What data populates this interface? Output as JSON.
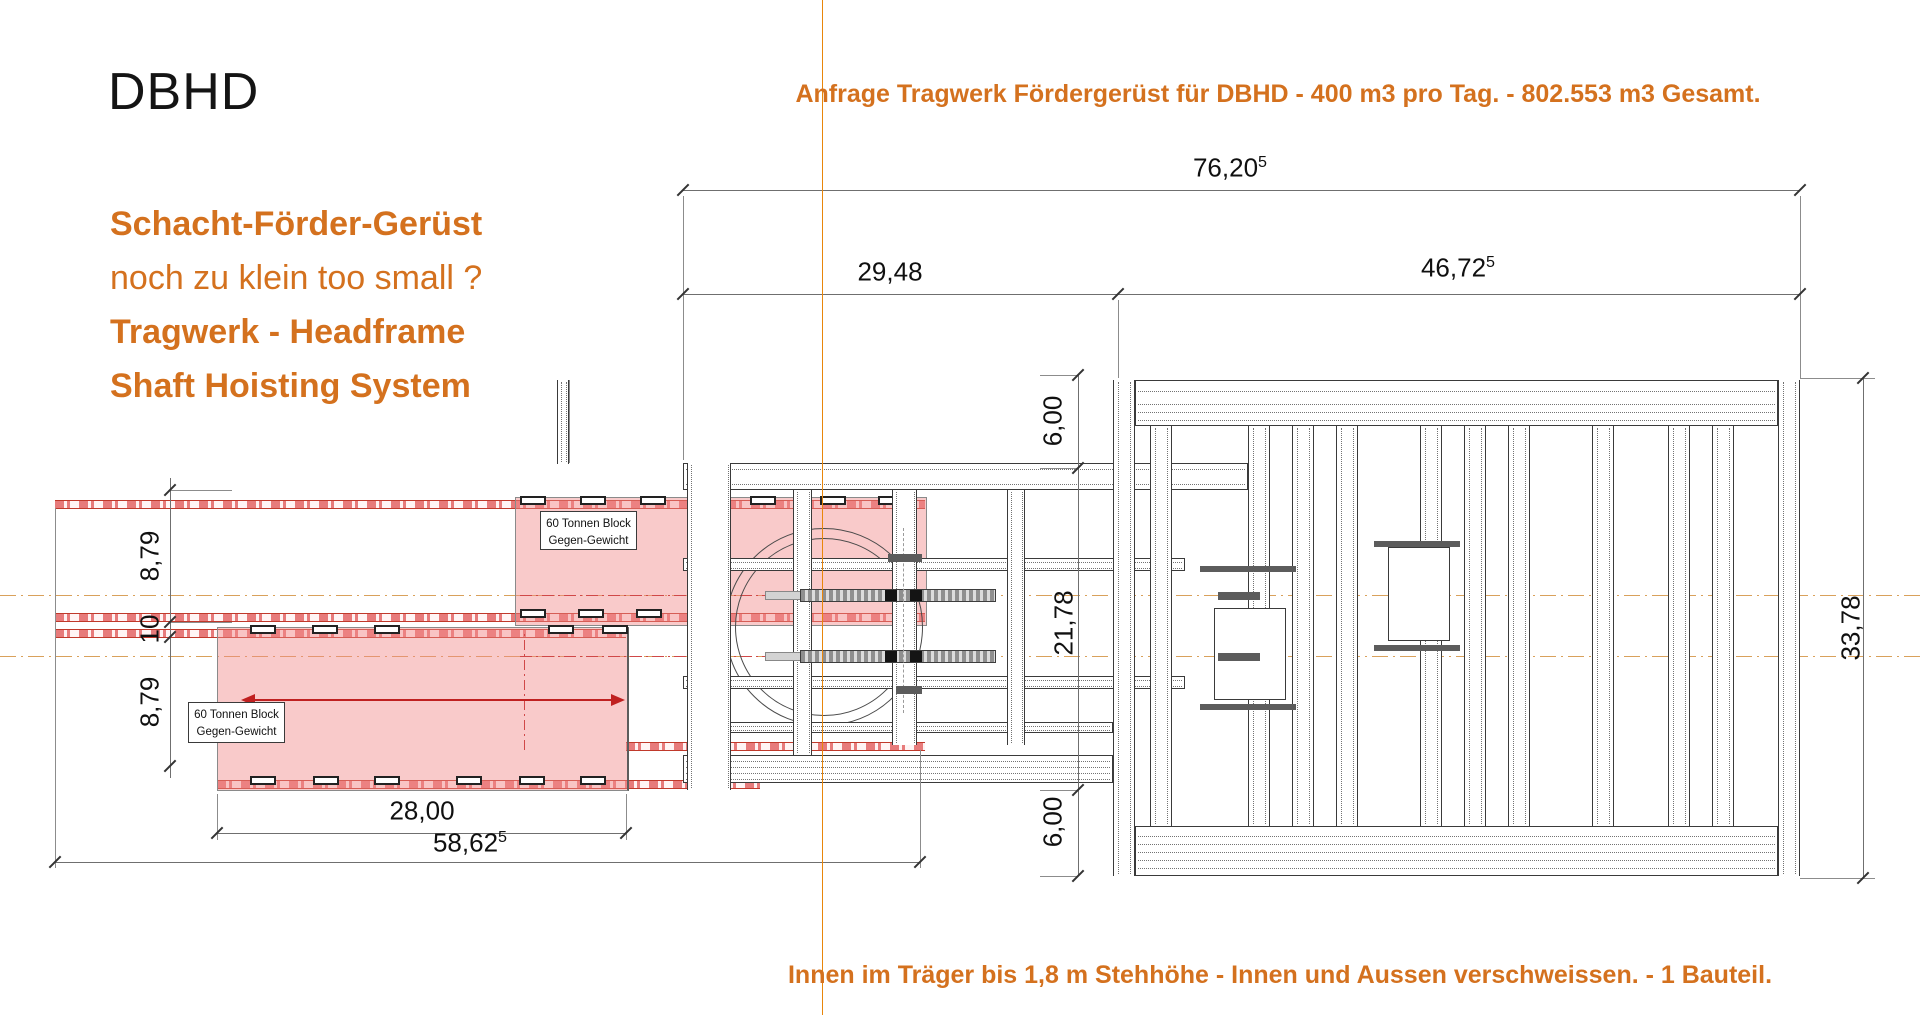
{
  "header": {
    "logo": "DBHD",
    "title": "Anfrage Tragwerk Fördergerüst für DBHD - 400 m3 pro Tag. - 802.553 m3  Gesamt."
  },
  "left_panel": {
    "lines": [
      {
        "text": "Schacht-Förder-Gerüst"
      },
      {
        "text": "noch zu klein too small ?"
      },
      {
        "text": "Tragwerk - Headframe"
      },
      {
        "text": "Shaft Hoisting System"
      }
    ]
  },
  "footer": {
    "note": "Innen im Träger bis 1,8 m Stehhöhe - Innen und Aussen verschweissen. - 1 Bauteil."
  },
  "drawing": {
    "counterweight_label": {
      "line1": "60 Tonnen Block",
      "line2": "Gegen-Gewicht"
    },
    "dimensions": {
      "total_width": {
        "value": "76,20",
        "sup": "5"
      },
      "left_span": {
        "value": "29,48",
        "sup": ""
      },
      "right_span": {
        "value": "46,72",
        "sup": "5"
      },
      "top_height": "6,00",
      "mid_height": "21,78",
      "bottom_height": "6,00",
      "overall_height": "33,78",
      "rail_upper": "8,79",
      "rail_gap": "10",
      "rail_lower": "8,79",
      "block_width": "28,00",
      "counterweight_travel": {
        "value": "58,62",
        "sup": "5"
      }
    },
    "colors": {
      "accent": "#D4711E",
      "pink_fill": "#F4A7A7",
      "red_line": "#C94040",
      "centerline_tan": "#D9A15B",
      "drawing_line": "#3A3A3A",
      "orange_axis": "#E8860B"
    }
  }
}
